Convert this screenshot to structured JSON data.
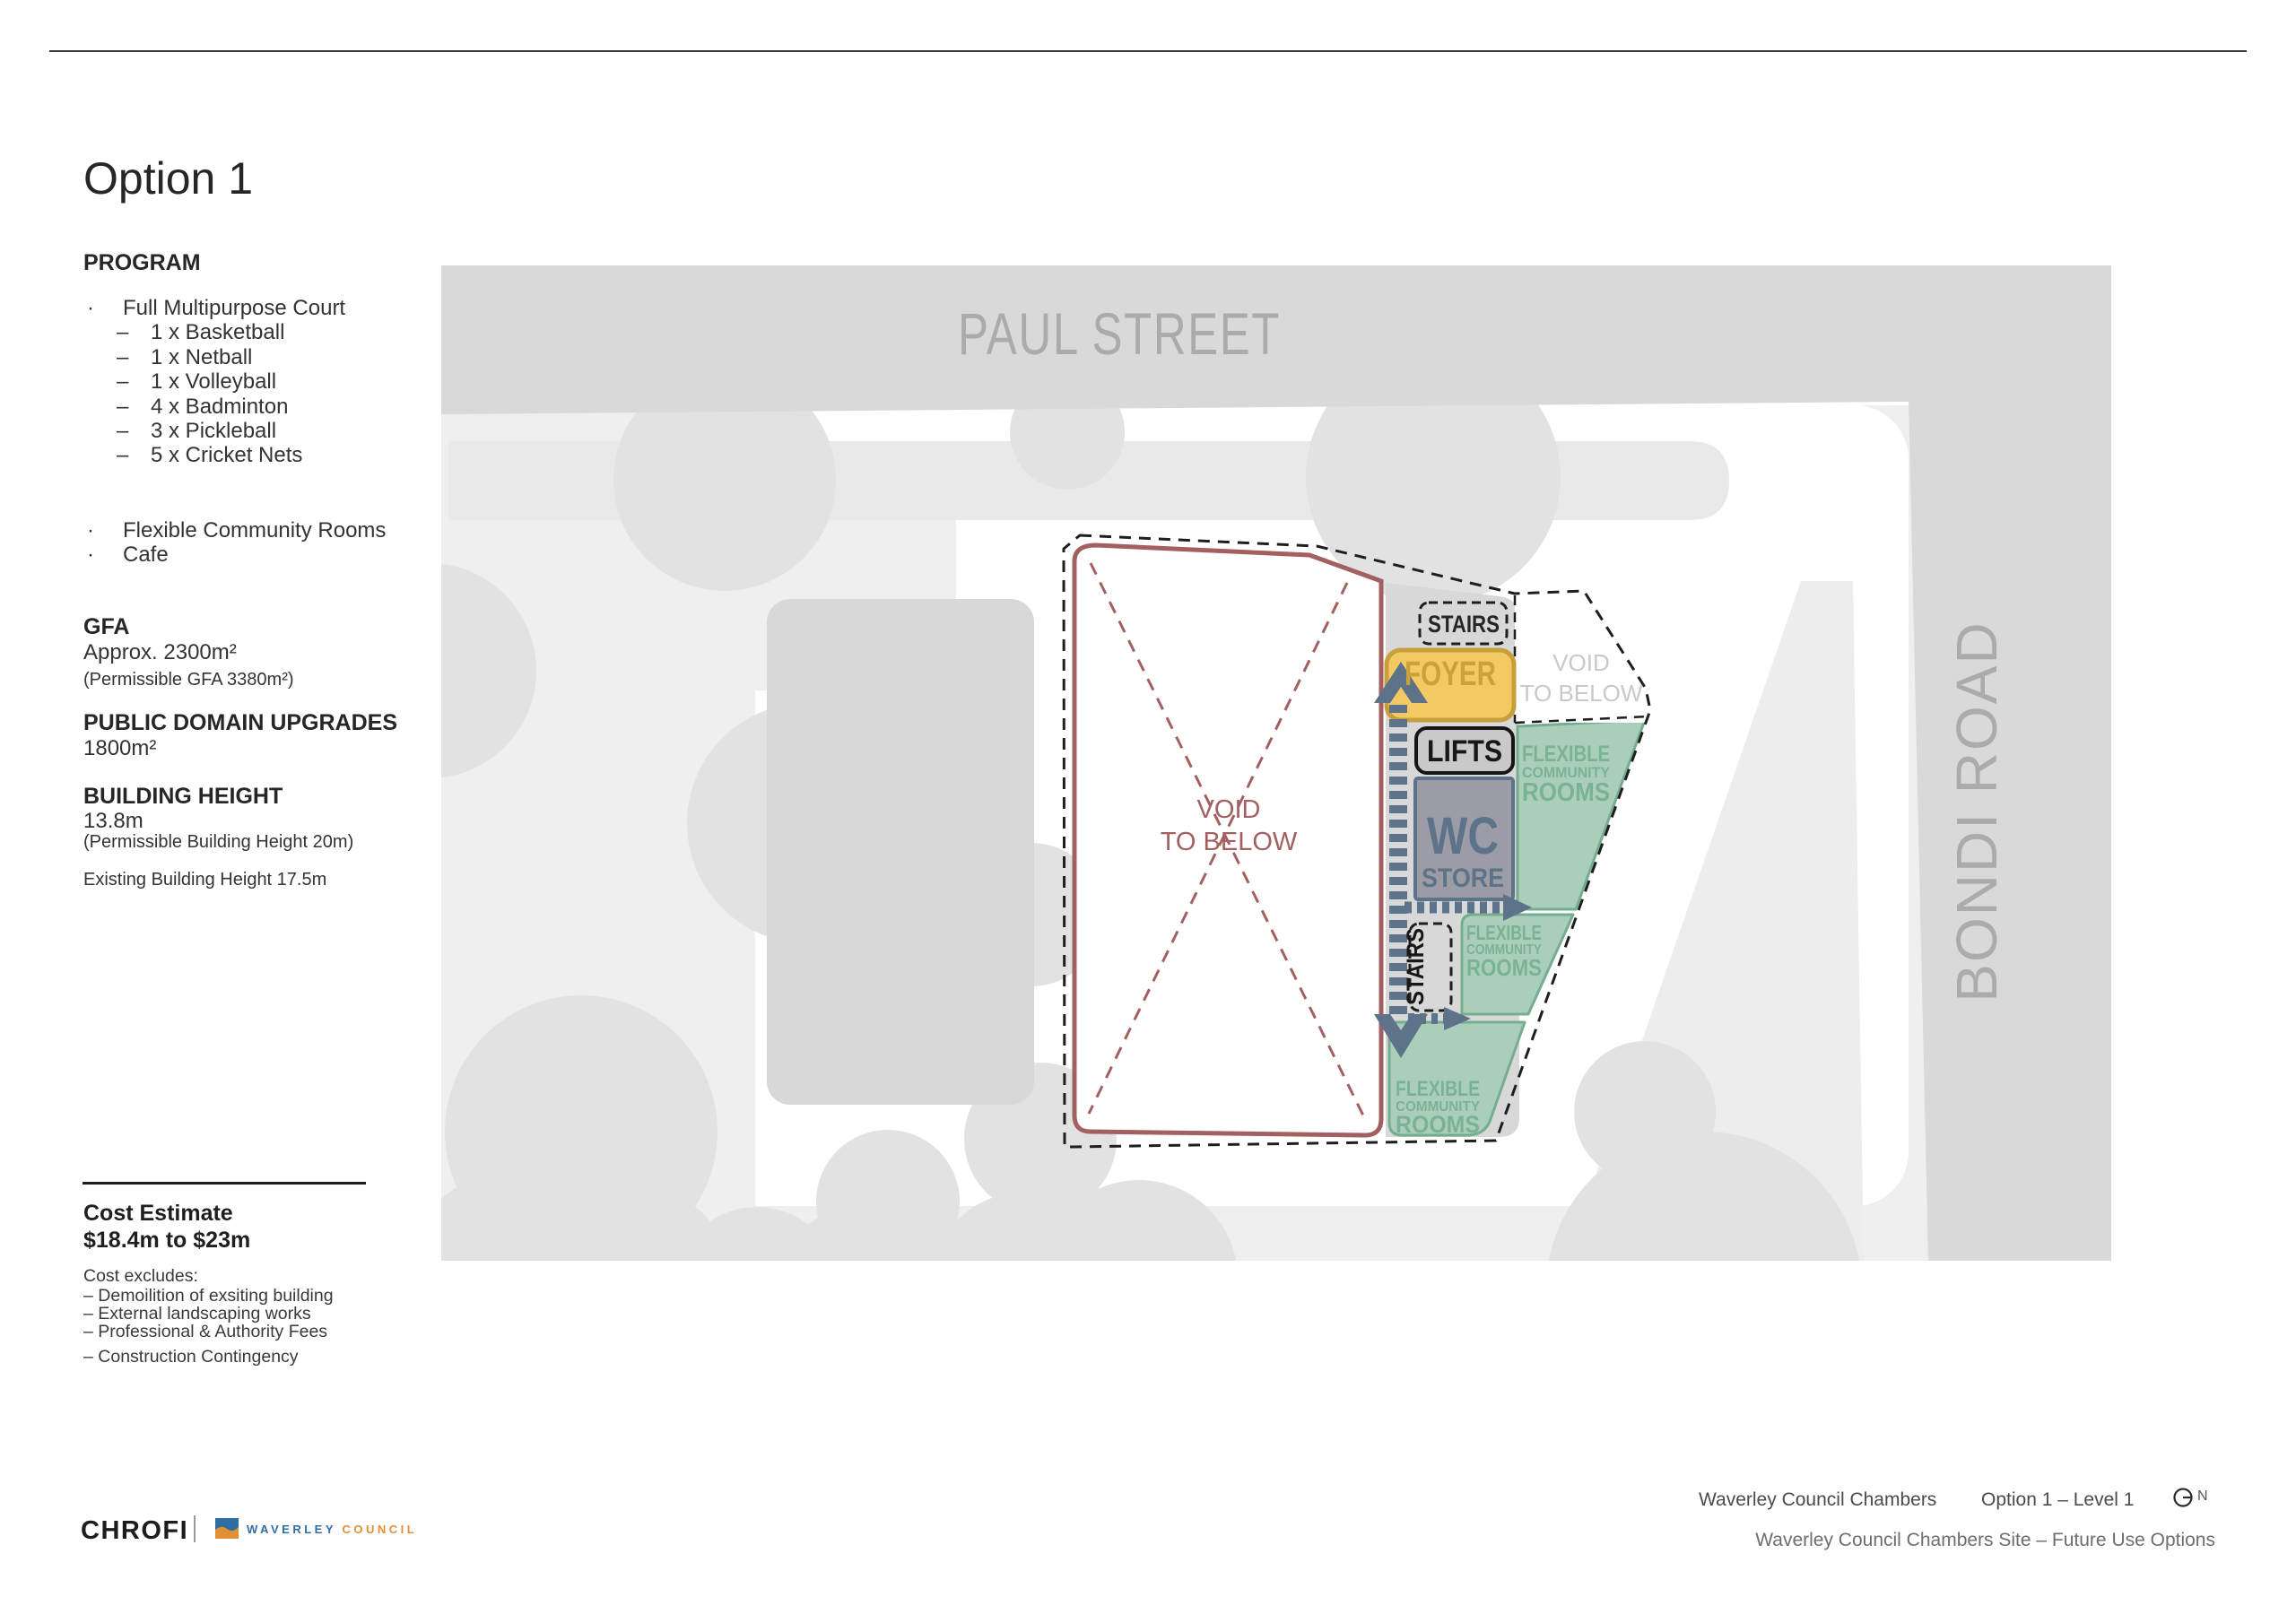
{
  "sidebar": {
    "title": "Option 1",
    "program": {
      "heading": "PROGRAM",
      "bullet": "·",
      "dash": "–",
      "item1": "Full Multipurpose Court",
      "sub": [
        "1 x Basketball",
        "1 x Netball",
        "1 x Volleyball",
        "4 x Badminton",
        "3 x Pickleball",
        "5 x Cricket Nets"
      ],
      "item2": "Flexible Community Rooms",
      "item3": "Cafe"
    },
    "gfa": {
      "heading": "GFA",
      "value": "Approx. 2300m²",
      "note": "(Permissible GFA 3380m²)"
    },
    "public_domain": {
      "heading": "PUBLIC DOMAIN UPGRADES",
      "value": "1800m²"
    },
    "building_height": {
      "heading": "BUILDING HEIGHT",
      "value": "13.8m",
      "note": "(Permissible Building Height 20m)",
      "existing": "Existing Building Height 17.5m"
    },
    "cost": {
      "heading": "Cost Estimate",
      "range": "$18.4m to $23m",
      "excludes_heading": "Cost excludes:",
      "excludes": [
        "– Demoilition of exsiting building",
        "– External landscaping works",
        "– Professional & Authority Fees",
        "– Construction Contingency"
      ]
    }
  },
  "map": {
    "paul_street": "PAUL STREET",
    "bondi_road": "BONDI ROAD",
    "plan": {
      "stairs_top": "STAIRS",
      "stairs_side": "STAIRS",
      "foyer": "FOYER",
      "lifts": "LIFTS",
      "wc": "WC",
      "store": "STORE",
      "flex": [
        "FLEXIBLE",
        "COMMUNITY",
        "ROOMS"
      ],
      "court_void": [
        "VOID",
        "TO BELOW"
      ],
      "void_below": [
        "VOID",
        "TO BELOW"
      ]
    }
  },
  "footer": {
    "brand": "CHROFI",
    "council": {
      "word1": "WAVERLEY",
      "word2": "COUNCIL"
    },
    "project": "Waverley Council Chambers",
    "sheet": "Option 1 – Level 1",
    "north": "N",
    "subtitle": "Waverley Council Chambers Site – Future Use Options"
  },
  "colors": {
    "street_band": "#d9d9d9",
    "street_text": "#ababab",
    "site_gray": "#efefef",
    "tree": "#e2e2e2",
    "building_ghost": "#d8d8d8",
    "court_maroon": "#a26060",
    "outline_dash": "#1e1e1e",
    "foyer_fill": "#f3c963",
    "foyer_accent": "#c7a03c",
    "lifts_fill": "#c9c9c9",
    "wc_fill": "#9c9ca7",
    "wc_accent": "#5d7389",
    "green_fill": "#abceba",
    "green_stroke": "#74ad8f",
    "green_text": "#7ab394",
    "circulation_blue": "#5d7389",
    "council_blue": "#2f6ea5",
    "council_orange": "#e28f35"
  }
}
